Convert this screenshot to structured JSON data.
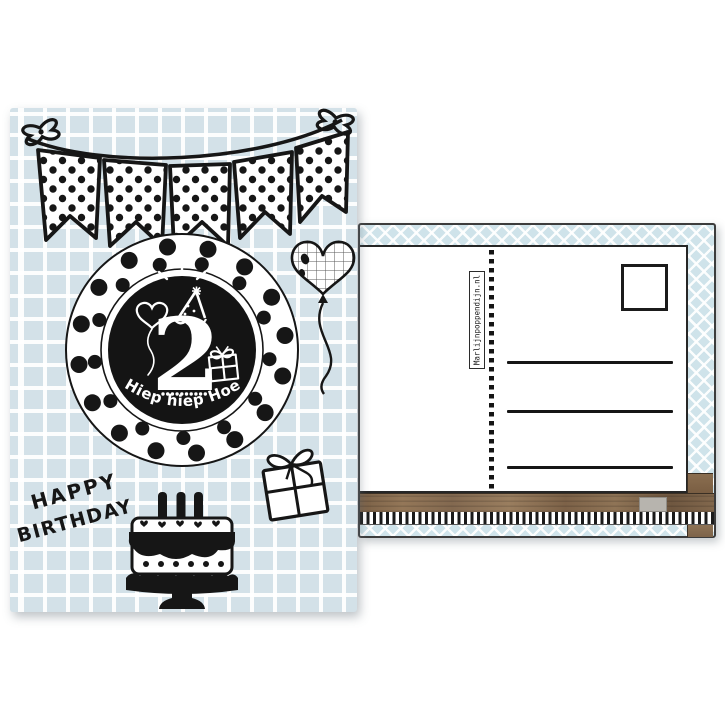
{
  "front_card": {
    "age_number": "2",
    "medallion_caption": "Hiep hiep Hoera",
    "greeting_word1": "HAPPY",
    "greeting_word2": "BIRTHDAY",
    "icons": [
      "bunting-banner",
      "bow",
      "polka-dot-medallion",
      "sparkle",
      "party-hat",
      "heart-balloon-small",
      "gift-small",
      "heart-balloon-grid",
      "gift-box",
      "birthday-cake"
    ],
    "colors": {
      "card_blue": "#d3e1e8",
      "grid_line": "#ffffff",
      "ink": "#161616",
      "medallion_disc": "#141414"
    }
  },
  "back_card": {
    "brand_vertical_text": "Marlijnpoppendijn.nl",
    "address_line_count": 3,
    "has_stamp_box": true,
    "colors": {
      "lattice_blue": "#cfe3ea",
      "lattice_line": "#ffffff",
      "panel_white": "#ffffff",
      "wood_brown": "#8a6d50",
      "ink": "#1a1a1a",
      "chip_gray": "#b7b4ae"
    }
  }
}
